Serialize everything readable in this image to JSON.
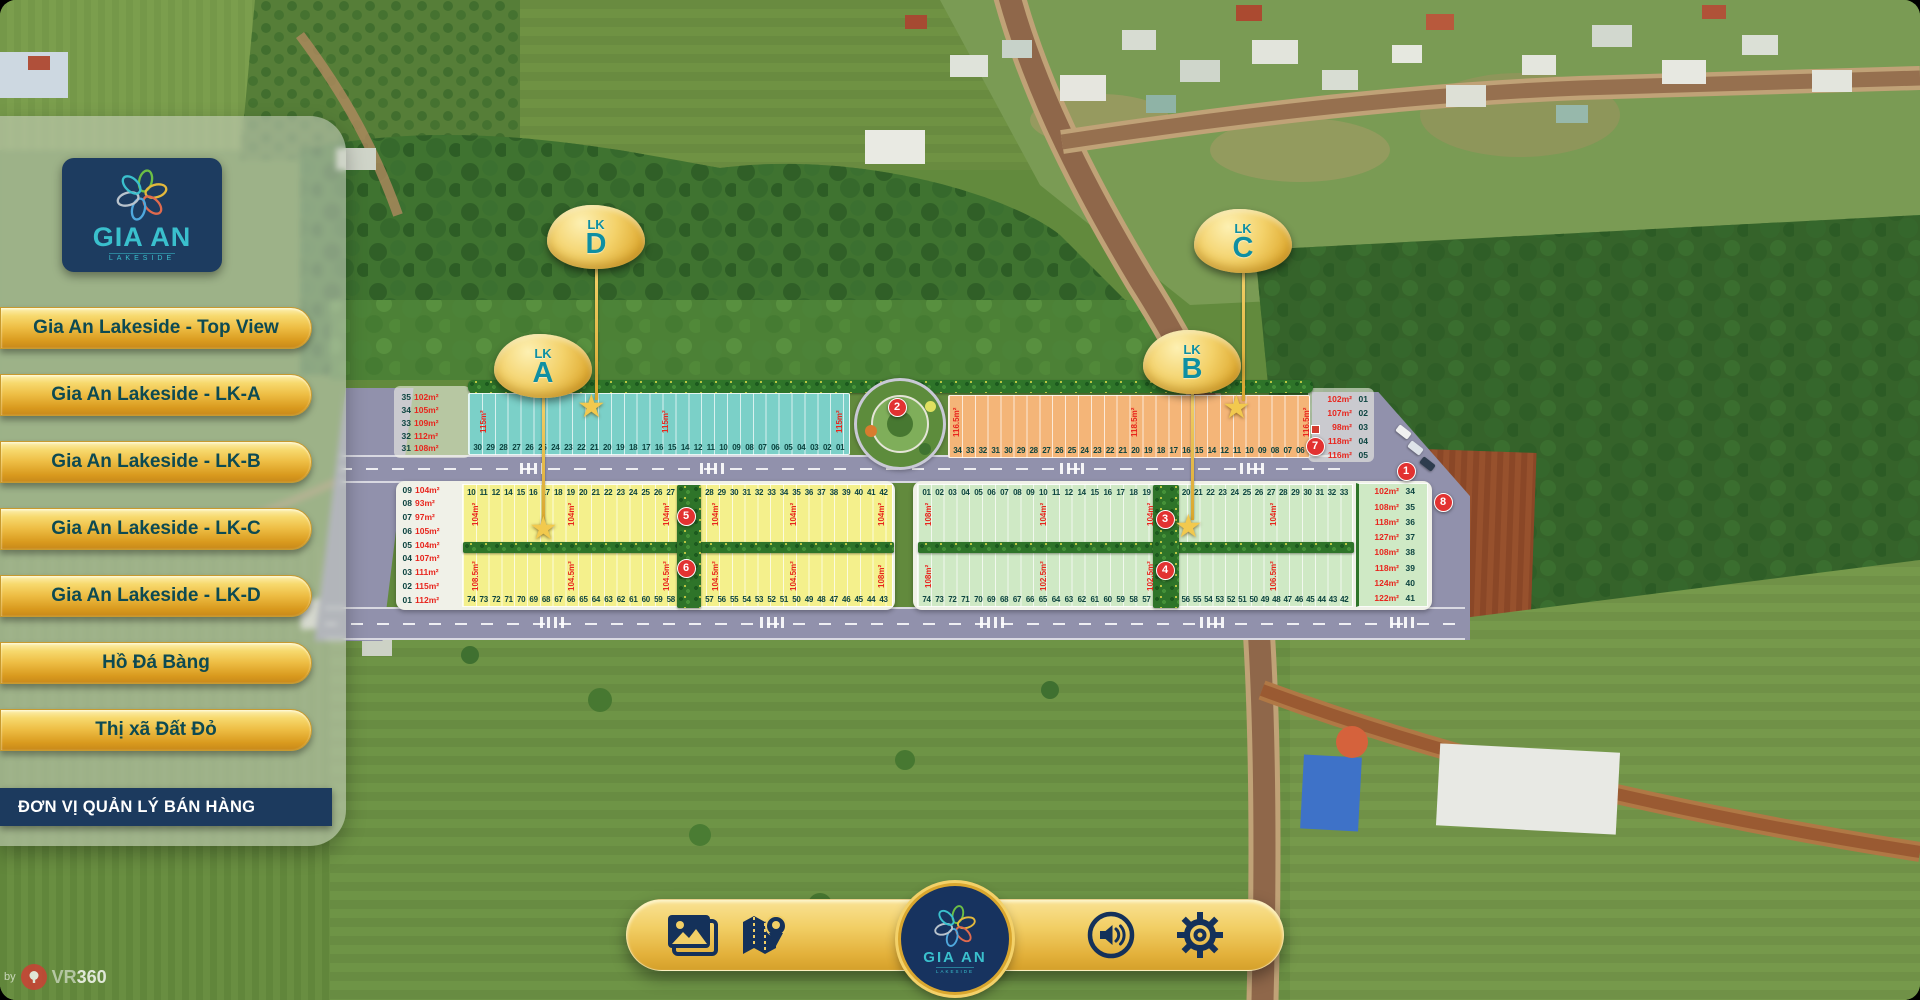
{
  "project": {
    "brand": "GIA AN",
    "brand_sub": "LAKESIDE"
  },
  "sidebar": {
    "buttons": [
      "Gia An Lakeside - Top View",
      "Gia An Lakeside - LK-A",
      "Gia An Lakeside - LK-B",
      "Gia An Lakeside - LK-C",
      "Gia An Lakeside - LK-D",
      "Hồ Đá Bàng",
      "Thị xã Đất Đỏ"
    ],
    "manager_button": "ĐƠN VỊ QUẢN LÝ BÁN HÀNG"
  },
  "map": {
    "balloons": [
      {
        "id": "lk-d",
        "top_text": "LK",
        "letter": "D",
        "x": 596,
        "y": 237,
        "stem_top": 266,
        "stem_bottom": 400,
        "star_x": 593,
        "star_y": 392
      },
      {
        "id": "lk-a",
        "top_text": "LK",
        "letter": "A",
        "x": 543,
        "y": 366,
        "stem_top": 395,
        "stem_bottom": 522,
        "star_x": 545,
        "star_y": 514
      },
      {
        "id": "lk-c",
        "top_text": "LK",
        "letter": "C",
        "x": 1243,
        "y": 241,
        "stem_top": 270,
        "stem_bottom": 401,
        "star_x": 1238,
        "star_y": 393
      },
      {
        "id": "lk-b",
        "top_text": "LK",
        "letter": "B",
        "x": 1192,
        "y": 362,
        "stem_top": 391,
        "stem_bottom": 520,
        "star_x": 1190,
        "star_y": 512
      }
    ],
    "numbered_markers": [
      {
        "n": "1",
        "x": 1406,
        "y": 471
      },
      {
        "n": "2",
        "x": 897,
        "y": 407
      },
      {
        "n": "3",
        "x": 1165,
        "y": 519
      },
      {
        "n": "4",
        "x": 1165,
        "y": 570
      },
      {
        "n": "5",
        "x": 686,
        "y": 516
      },
      {
        "n": "6",
        "x": 686,
        "y": 568
      },
      {
        "n": "7",
        "x": 1315,
        "y": 446
      },
      {
        "n": "8",
        "x": 1443,
        "y": 502
      }
    ],
    "blocks": {
      "lkd": {
        "color": "#7bd0c8",
        "left_labels": [
          {
            "no": "35",
            "area": "102m²"
          },
          {
            "no": "34",
            "area": "105m²"
          },
          {
            "no": "33",
            "area": "109m²"
          },
          {
            "no": "32",
            "area": "112m²"
          },
          {
            "no": "31",
            "area": "108m²"
          }
        ],
        "bottom_numbers": [
          "30",
          "29",
          "28",
          "27",
          "26",
          "25",
          "24",
          "23",
          "22",
          "21",
          "20",
          "19",
          "18",
          "17",
          "16",
          "15",
          "14",
          "12",
          "11",
          "10",
          "09",
          "08",
          "07",
          "06",
          "05",
          "04",
          "03",
          "02",
          "01"
        ],
        "area_labels": [
          {
            "t": "115m²",
            "x": 480
          },
          {
            "t": "115m²",
            "x": 662
          },
          {
            "t": "115m²",
            "x": 836
          }
        ]
      },
      "lkc": {
        "color": "#f4b578",
        "bottom_numbers": [
          "34",
          "33",
          "32",
          "31",
          "30",
          "29",
          "28",
          "27",
          "26",
          "25",
          "24",
          "23",
          "22",
          "21",
          "20",
          "19",
          "18",
          "17",
          "16",
          "15",
          "14",
          "12",
          "11",
          "10",
          "09",
          "08",
          "07",
          "06"
        ],
        "right_labels": [
          {
            "area": "102m²",
            "no": "01"
          },
          {
            "area": "107m²",
            "no": "02"
          },
          {
            "area": "98m²",
            "no": "03"
          },
          {
            "area": "118m²",
            "no": "04"
          },
          {
            "area": "116m²",
            "no": "05"
          }
        ],
        "area_labels": [
          {
            "t": "116.5m²",
            "x": 953
          },
          {
            "t": "118.5m²",
            "x": 1131
          },
          {
            "t": "116.5m²",
            "x": 1303
          }
        ]
      },
      "lka": {
        "color": "#f4f08c",
        "left_labels": [
          {
            "no": "09",
            "area": "104m²"
          },
          {
            "no": "08",
            "area": "93m²"
          },
          {
            "no": "07",
            "area": "97m²"
          },
          {
            "no": "06",
            "area": "105m²"
          },
          {
            "no": "05",
            "area": "104m²"
          },
          {
            "no": "04",
            "area": "107m²"
          },
          {
            "no": "03",
            "area": "111m²"
          },
          {
            "no": "02",
            "area": "115m²"
          },
          {
            "no": "01",
            "area": "112m²"
          }
        ],
        "top_numbers_left": [
          "10",
          "11",
          "12",
          "14",
          "15",
          "16",
          "17",
          "18",
          "19",
          "20",
          "21",
          "22",
          "23",
          "24",
          "25",
          "26",
          "27"
        ],
        "top_numbers_right": [
          "28",
          "29",
          "30",
          "31",
          "32",
          "33",
          "34",
          "35",
          "36",
          "37",
          "38",
          "39",
          "40",
          "41",
          "42"
        ],
        "bottom_numbers_left": [
          "74",
          "73",
          "72",
          "71",
          "70",
          "69",
          "68",
          "67",
          "66",
          "65",
          "64",
          "63",
          "62",
          "61",
          "60",
          "59",
          "58"
        ],
        "bottom_numbers_right": [
          "57",
          "56",
          "55",
          "54",
          "53",
          "52",
          "51",
          "50",
          "49",
          "48",
          "47",
          "46",
          "45",
          "44",
          "43"
        ],
        "area_labels": [
          {
            "t": "104m²",
            "x": 472,
            "half": "top"
          },
          {
            "t": "104m²",
            "x": 568,
            "half": "top"
          },
          {
            "t": "104m²",
            "x": 663,
            "half": "top"
          },
          {
            "t": "104m²",
            "x": 712,
            "half": "top"
          },
          {
            "t": "104m²",
            "x": 790,
            "half": "top"
          },
          {
            "t": "104m²",
            "x": 878,
            "half": "top"
          },
          {
            "t": "108.5m²",
            "x": 472,
            "half": "bottom"
          },
          {
            "t": "104.5m²",
            "x": 568,
            "half": "bottom"
          },
          {
            "t": "104.5m²",
            "x": 663,
            "half": "bottom"
          },
          {
            "t": "104.5m²",
            "x": 712,
            "half": "bottom"
          },
          {
            "t": "104.5m²",
            "x": 790,
            "half": "bottom"
          },
          {
            "t": "108m²",
            "x": 878,
            "half": "bottom"
          }
        ]
      },
      "lkb": {
        "color": "#cfe9c5",
        "top_numbers_left": [
          "01",
          "02",
          "03",
          "04",
          "05",
          "06",
          "07",
          "08",
          "09",
          "10",
          "11",
          "12",
          "14",
          "15",
          "16",
          "17",
          "18",
          "19"
        ],
        "top_numbers_right": [
          "20",
          "21",
          "22",
          "23",
          "24",
          "25",
          "26",
          "27",
          "28",
          "29",
          "30",
          "31",
          "32",
          "33"
        ],
        "bottom_numbers_left": [
          "74",
          "73",
          "72",
          "71",
          "70",
          "69",
          "68",
          "67",
          "66",
          "65",
          "64",
          "63",
          "62",
          "61",
          "60",
          "59",
          "58",
          "57"
        ],
        "bottom_numbers_right": [
          "56",
          "55",
          "54",
          "53",
          "52",
          "51",
          "50",
          "49",
          "48",
          "47",
          "46",
          "45",
          "44",
          "43",
          "42"
        ],
        "right_plots": [
          {
            "area": "102m²",
            "no": "34"
          },
          {
            "area": "108m²",
            "no": "35"
          },
          {
            "area": "118m²",
            "no": "36"
          },
          {
            "area": "127m²",
            "no": "37"
          },
          {
            "area": "108m²",
            "no": "38"
          },
          {
            "area": "118m²",
            "no": "39"
          },
          {
            "area": "124m²",
            "no": "40"
          },
          {
            "area": "122m²",
            "no": "41"
          }
        ],
        "area_labels": [
          {
            "t": "108m²",
            "x": 925,
            "half": "top"
          },
          {
            "t": "104m²",
            "x": 1040,
            "half": "top"
          },
          {
            "t": "104m²",
            "x": 1147,
            "half": "top"
          },
          {
            "t": "104m²",
            "x": 1270,
            "half": "top"
          },
          {
            "t": "108m²",
            "x": 925,
            "half": "bottom"
          },
          {
            "t": "102.5m²",
            "x": 1040,
            "half": "bottom"
          },
          {
            "t": "102.5m²",
            "x": 1147,
            "half": "bottom"
          },
          {
            "t": "106.5m²",
            "x": 1270,
            "half": "bottom"
          }
        ]
      }
    }
  },
  "toolbar": {
    "icons": [
      "gallery",
      "map-location",
      "audio",
      "settings"
    ]
  },
  "watermark": {
    "prefix": "by",
    "brand_vr": "VR",
    "brand_360": "360"
  },
  "colors": {
    "gold": "#e9b949",
    "navy": "#17335f",
    "teal_text": "#0d4a52",
    "marker_red": "#e23231",
    "block_lkd": "#7bd0c8",
    "block_lkc": "#f4b578",
    "block_lka": "#f4f08c",
    "block_lkb": "#cfe9c5",
    "road": "#9191ac"
  }
}
